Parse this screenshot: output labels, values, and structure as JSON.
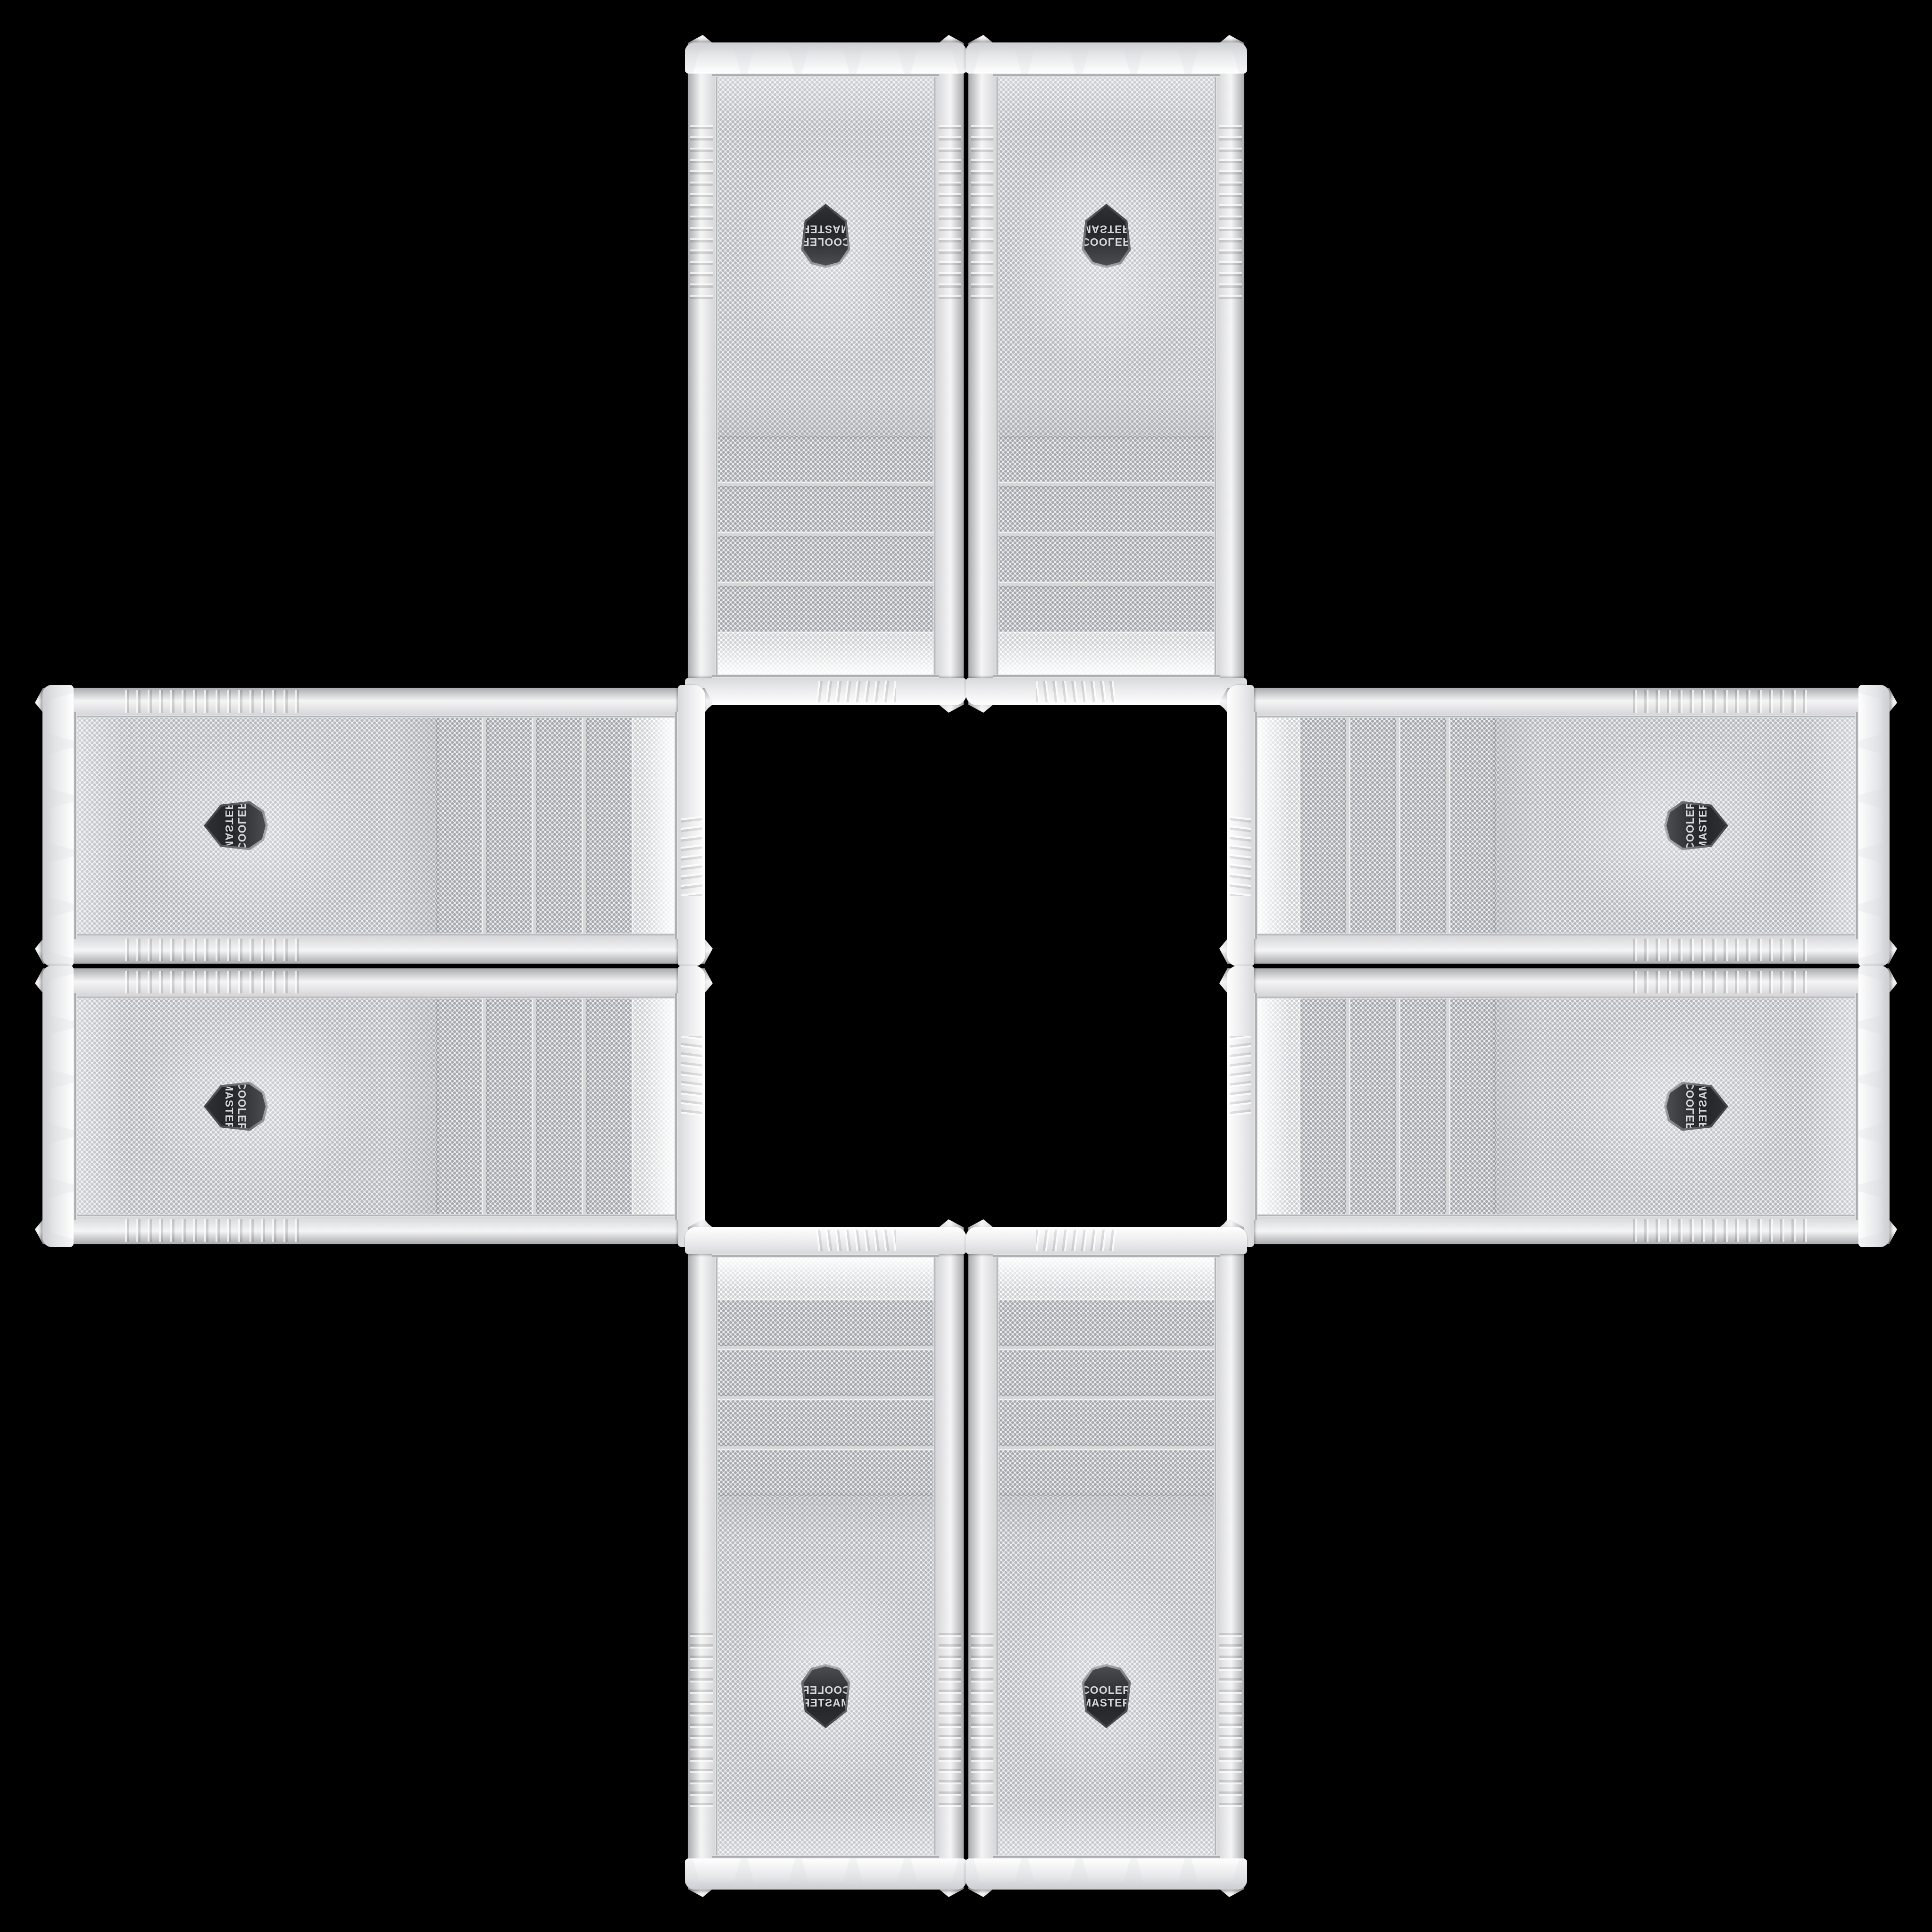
{
  "scene": {
    "background_color": "#000000",
    "layout": "eight identical white PC-case front panels arranged in a cross / plus pattern on black"
  },
  "badge": {
    "line1": "COOLER",
    "line2": "MASTER",
    "badge_background": "#232428",
    "badge_text_color": "#d7d8da",
    "badge_rim_color": "#bdbec1"
  },
  "colors": {
    "case_white": "#f5f5f6",
    "case_shadow_gray": "#a9aaad",
    "mesh_background": "#eff0f2",
    "mesh_dot": "#b6b9bd",
    "bay_dot": "#a6a9ad",
    "chrome_trim": "#94969a",
    "background": "#000000"
  },
  "cases": [
    {
      "id": "top-left",
      "orientation": "rotated-180"
    },
    {
      "id": "top-right",
      "orientation": "flipped-vertical"
    },
    {
      "id": "left-upper",
      "orientation": "rotated-90-cw-flipped"
    },
    {
      "id": "left-lower",
      "orientation": "rotated-90-cw"
    },
    {
      "id": "right-upper",
      "orientation": "rotated-90-ccw"
    },
    {
      "id": "right-lower",
      "orientation": "rotated-90-ccw-flipped"
    },
    {
      "id": "bottom-left",
      "orientation": "mirrored-horizontal"
    },
    {
      "id": "bottom-right",
      "orientation": "upright"
    }
  ]
}
